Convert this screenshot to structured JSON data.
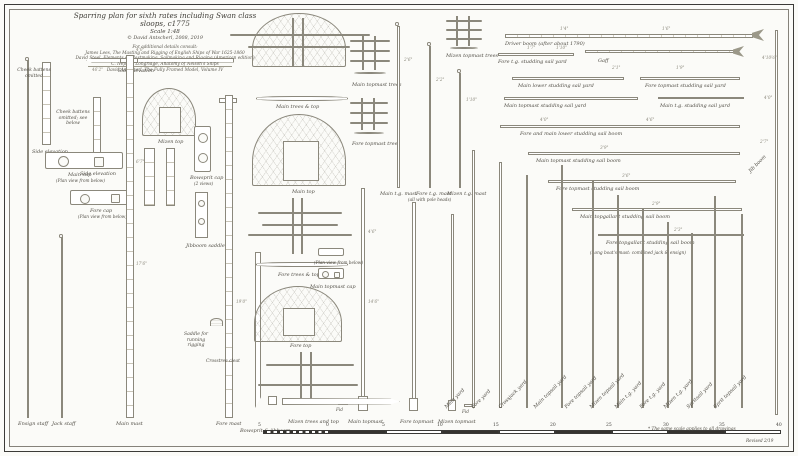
{
  "title_block": {
    "title": "Sparring plan for sixth rates including Swan class sloops, c1775",
    "scale": "Scale 1:48",
    "author": "© David Antscherl, 2008, 2019",
    "refs_intro": "For additional details consult:",
    "refs": [
      "James Lees, The Masting and Rigging of English Ships of War 1625-1860",
      "David Steel, Elements of Mastmaking, Sailmaking and Rigging (American edition)",
      "C. Nepean Longridge, Anatomy of Nelson's Ships",
      "David Antscherl, The Fully Framed Model, Volume IV"
    ]
  },
  "mast_labels": {
    "ensign_staff": "Ensign staff",
    "jack_staff": "Jack staff",
    "main_mast": "Main mast",
    "fore_mast": "Fore mast",
    "bowsprit": "Bowsprit & jibboom",
    "main_topmast": "Main topmast",
    "fore_topmast": "Fore topmast",
    "mizen_topmast": "Mizen topmast",
    "main_tg_mast": "Main t.g. mast",
    "fore_tg_mast": "Fore t.g. mast",
    "mizen_tg_mast": "Mizen t.g. mast",
    "tg_note": "(all with pole heads)",
    "jib_boom": "Jib boom"
  },
  "yards": [
    "Main yard",
    "Fore yard",
    "Crossjack yard",
    "Main topsail yard",
    "Fore topsail yard",
    "Mizen topsail yard",
    "Main t.g. yard",
    "Fore t.g. yard",
    "Mizen t.g. yard",
    "Spritsail yard",
    "Sprit topsail yard"
  ],
  "right_spars": {
    "driver_boom": "Driver boom (after about 1790)",
    "fore_tg_stun_yard": "Fore t.g. studding sail yard",
    "gaff": "Gaff",
    "main_lower_stun_yard": "Main lower studding sail yard",
    "fore_topmast_stun_yard": "Fore topmast studding sail yard",
    "main_topmast_stun_yard": "Main topmast studding sail yard",
    "main_tg_stun_yard": "Main t.g. studding sail yard",
    "lower_stun_boom": "Fore and main lower studding sail boom",
    "main_topmast_stun_boom": "Main topmast studding sail boom",
    "fore_topmast_stun_boom": "Fore topmast studding sail boom",
    "main_tg_stun_boom": "Main topgallant studding sail boom",
    "fore_tg_stun_boom": "Fore topgallant studding sail boom",
    "longboat_note": "(Long boat's mast: combined jack & ensign)"
  },
  "detail_labels": {
    "cheek_battens": "Cheek battens omitted",
    "cheek_battens2": "Cheek battens omitted; see below",
    "side_elevation1": "Side elevation",
    "side_elevation2": "Side elevation",
    "side_elevation3": "Side elevation",
    "main_cap": "Main cap",
    "fore_cap": "Fore cap",
    "plan_below1": "(Plan view from below)",
    "plan_below2": "(Plan view from below)",
    "plan_below3": "(Plan view from below)",
    "mizen_top": "Mizen top",
    "main_top": "Main top",
    "fore_top": "Fore top",
    "main_trees_top": "Main trees & top",
    "fore_trees_top": "Fore trees & top",
    "mizen_trees_top": "Mizen trees and top",
    "main_topmast_trees": "Main topmast trees",
    "fore_topmast_trees": "Fore topmast trees",
    "mizen_topmast_trees": "Mizen topmast trees",
    "main_topmast_cap": "Main topmast cap",
    "bowsprit_cap": "Bowsprit cap",
    "bowsprit_cap_views": "(2 views)",
    "jibboom_saddle": "Jibboom saddle",
    "saddle": "Saddle for running rigging",
    "cleat": "Crosstree cleat",
    "fid1": "Fid",
    "fid2": "Fid"
  },
  "dims": {
    "fish_len": "46'2\"",
    "d1": "4'0\"",
    "d2": "6'7\"",
    "d3": "17'6\"",
    "d4": "19'0\"",
    "d5": "2'6\"",
    "d6": "2'2\"",
    "d7": "1'10\"",
    "d8": "4'6\"",
    "d9": "14'6\"",
    "d10": "1'7\"",
    "d11": "1'10\"",
    "d12": "2'1\"",
    "d13": "1'9\"",
    "d14": "4'0\"",
    "d15": "4'6\"",
    "d16": "3'9\"",
    "d17": "3'6\"",
    "d18": "2'9\"",
    "d19": "2'3\"",
    "d20": "4'10½\"",
    "d21": "4'0\"",
    "d22": "2'7\"",
    "d23": "1'4\"",
    "d24": "1'6\""
  },
  "scale_bar": {
    "numbers": [
      "5",
      "0",
      "5",
      "10",
      "15",
      "20",
      "25",
      "30",
      "35",
      "40"
    ]
  },
  "footnotes": {
    "note": "* The same scale applies to all drawings",
    "revised": "Revised 2/19"
  }
}
